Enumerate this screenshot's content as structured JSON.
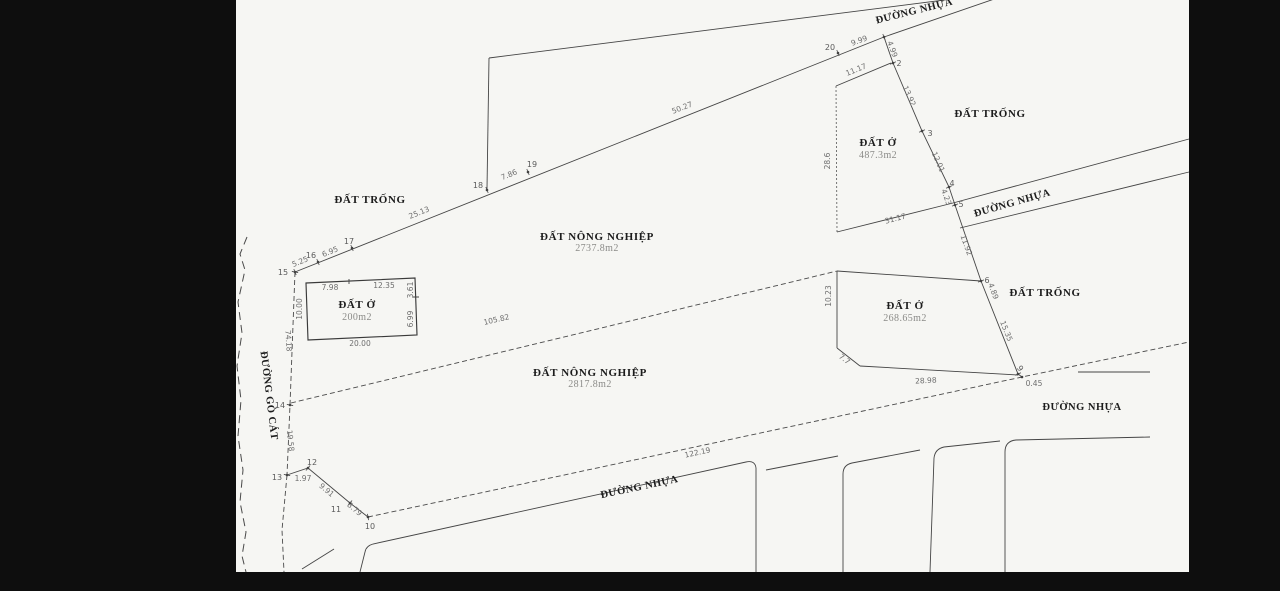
{
  "scene": {
    "background": "#0e0e0e",
    "paper_color": "#f6f6f3",
    "ink_color": "#454545"
  },
  "roads": {
    "top": "ĐƯỜNG NHỰA",
    "right": "ĐƯỜNG NHỰA",
    "bottom_right": "ĐƯỜNG NHỰA",
    "bottom": "ĐƯỜNG NHỰA",
    "left": "ĐƯỜNG GÒ CÁT"
  },
  "parcels": {
    "vacant_top_left": "ĐẤT TRỐNG",
    "vacant_top_right": "ĐẤT TRỐNG",
    "vacant_right": "ĐẤT TRỐNG",
    "agri_upper": {
      "name": "ĐẤT NÔNG NGHIỆP",
      "area": "2737.8m2"
    },
    "agri_lower": {
      "name": "ĐẤT NÔNG NGHIỆP",
      "area": "2817.8m2"
    },
    "res_200": {
      "name": "ĐẤT Ở",
      "area": "200m2"
    },
    "res_487": {
      "name": "ĐẤT Ở",
      "area": "487.3m2"
    },
    "res_268": {
      "name": "ĐẤT Ở",
      "area": "268.65m2"
    }
  },
  "points": {
    "p2": "2",
    "p3": "3",
    "p4": "4",
    "p5": "5",
    "p6": "6",
    "p9": "9",
    "p10": "10",
    "p11": "11",
    "p12": "12",
    "p13": "13",
    "p14": "14",
    "p15": "15",
    "p16": "16",
    "p17": "17",
    "p18": "18",
    "p19": "19",
    "p20": "20"
  },
  "dims": {
    "d5_25": "5.25",
    "d6_95": "6.95",
    "d25_13": "25.13",
    "d7_86": "7.86",
    "d50_27": "50.27",
    "d9_99": "9.99",
    "d4_99": "4.99",
    "d11_17": "11.17",
    "d13_92": "13.92",
    "d12_01": "12.01",
    "d4_23": "4.23",
    "d11_92": "11.92",
    "d4_89": "4.89",
    "d15_35": "15.35",
    "d0_45": "0.45",
    "d28_6": "28.6",
    "d31_17": "31.17",
    "d10_23": "10.23",
    "d7_7": "7.7",
    "d28_98": "28.98",
    "d105_82": "105.82",
    "d122_19": "122.19",
    "d74_18": "74.18",
    "d19_58": "19.58",
    "d1_97": "1.97",
    "d9_91": "9.91",
    "d3_79": "3.79",
    "d7_98": "7.98",
    "d12_35": "12.35",
    "d10_00": "10.00",
    "d3_61": "3.61",
    "d6_99": "6.99",
    "d20_00": "20.00"
  }
}
